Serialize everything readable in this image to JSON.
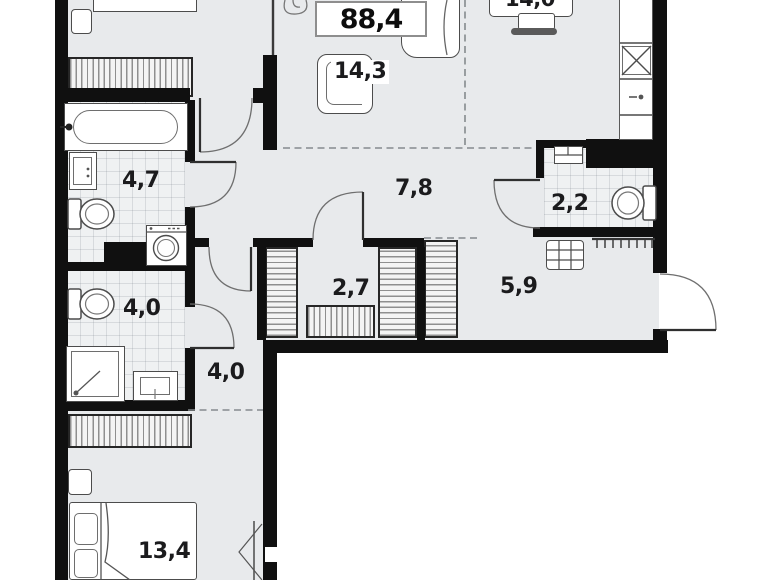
{
  "plan": {
    "total_area": "88,4",
    "rooms": [
      {
        "name": "living-room",
        "area_label": "14,3"
      },
      {
        "name": "kitchen-dining",
        "area_label": "14,0"
      },
      {
        "name": "bathroom-upper",
        "area_label": "4,7"
      },
      {
        "name": "hallway",
        "area_label": "7,8"
      },
      {
        "name": "wc",
        "area_label": "2,2"
      },
      {
        "name": "bathroom-lower",
        "area_label": "4,0"
      },
      {
        "name": "walk-in-closet",
        "area_label": "2,7"
      },
      {
        "name": "entry-hall",
        "area_label": "5,9"
      },
      {
        "name": "corridor",
        "area_label": "4,0"
      },
      {
        "name": "bedroom",
        "area_label": "13,4"
      }
    ]
  }
}
